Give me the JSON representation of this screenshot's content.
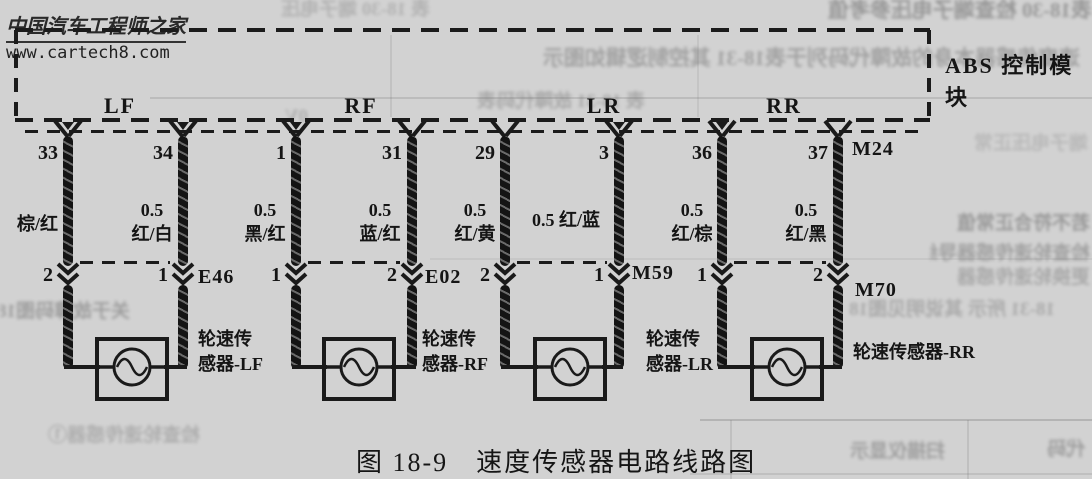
{
  "watermark": {
    "title": "中国汽车工程师之家",
    "url": "www.cartech8.com"
  },
  "module": {
    "name": "ABS 控制模块",
    "connector": "M24"
  },
  "channels": [
    {
      "label": "LF"
    },
    {
      "label": "RF"
    },
    {
      "label": "LR"
    },
    {
      "label": "RR"
    }
  ],
  "wires": [
    {
      "top_pin": "33",
      "wire_label": "棕/红",
      "bottom_pin": "2"
    },
    {
      "top_pin": "34",
      "wire_size": "0.5",
      "wire_label": "红/白",
      "bottom_pin": "1",
      "connector": "E46"
    },
    {
      "top_pin": "1",
      "wire_size": "0.5",
      "wire_label": "黑/红",
      "bottom_pin": "1"
    },
    {
      "top_pin": "31",
      "wire_size": "0.5",
      "wire_label": "蓝/红",
      "bottom_pin": "2",
      "connector": "E02"
    },
    {
      "top_pin": "29",
      "wire_size": "0.5",
      "wire_label": "红/黄",
      "bottom_pin": "2"
    },
    {
      "top_pin": "3",
      "wire_size": "0.5",
      "wire_label": "红/蓝",
      "bottom_pin": "1",
      "connector": "M59"
    },
    {
      "top_pin": "36",
      "wire_size": "0.5",
      "wire_label": "红/棕",
      "bottom_pin": "1"
    },
    {
      "top_pin": "37",
      "wire_size": "0.5",
      "wire_label": "红/黑",
      "bottom_pin": "2",
      "connector": "M70"
    }
  ],
  "sensors": [
    {
      "name_line1": "轮速传",
      "name_line2": "感器-LF"
    },
    {
      "name_line1": "轮速传",
      "name_line2": "感器-RF"
    },
    {
      "name_line1": "轮速传",
      "name_line2": "感器-LR"
    },
    {
      "name": "轮速传感器-RR"
    }
  ],
  "caption": "图 18-9　速度传感器电路线路图",
  "bleedthrough": [
    "表18-30 检查端子电压参考值",
    "表 18-30 端子电压",
    "速度传感器本身的故障代码列于表18-31 其控制逻辑如图示",
    "表 18-31 故障代码表",
    "0V",
    "端子电压正常",
    "若不符合正常值",
    "检查轮速传感器导线",
    "更换轮速传感器",
    "关于故障码图18",
    "18-31 所示 其说明见图18",
    "检查轮速传感器①",
    "扫描仪显示",
    "代码"
  ]
}
